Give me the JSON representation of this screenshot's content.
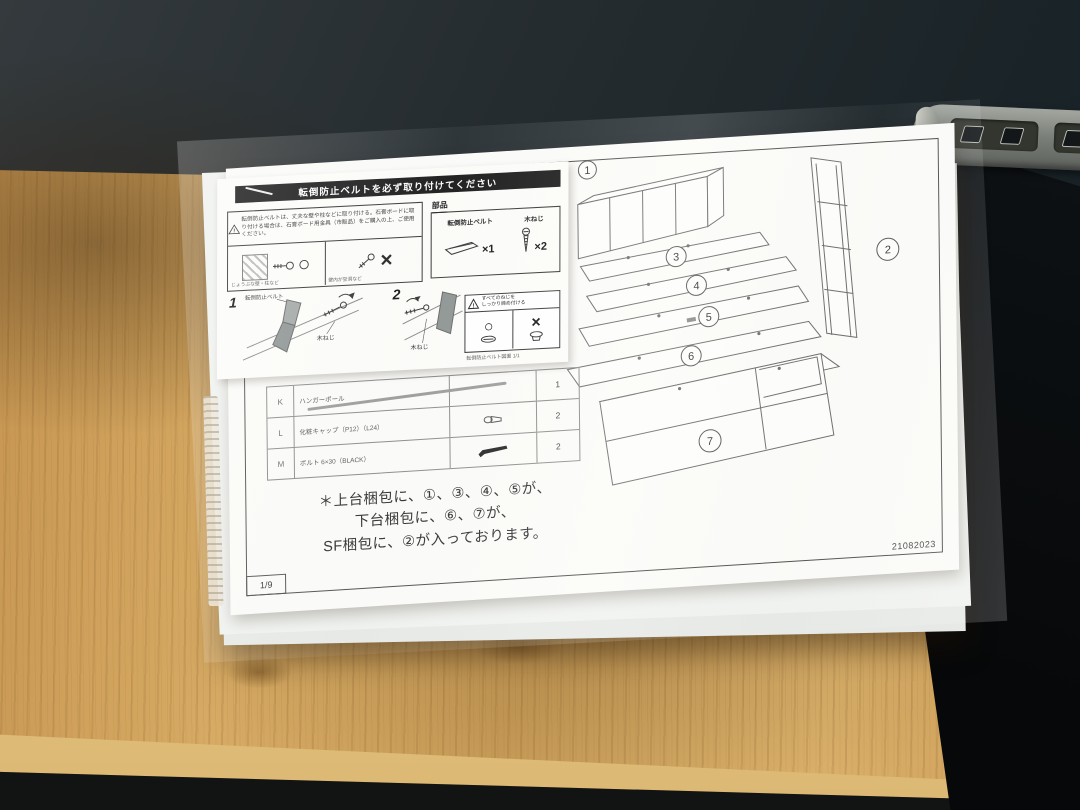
{
  "overlay_sheet": {
    "header": "転倒防止ベルトを必ず取り付けてください",
    "warning_text": "転倒防止ベルトは、丈夫な壁や柱などに取り付ける。石膏ボードに取り付ける場合は、石膏ボード用金具（市販品）をご購入の上、ご使用ください。",
    "ok_mark": "○",
    "ng_mark": "×",
    "ok_caption": "じょうぶな壁・柱など",
    "ng_caption": "壁内が空洞など",
    "parts_title": "部品",
    "belt_label": "転倒防止ベルト",
    "belt_qty": "×1",
    "screw_label": "木ねじ",
    "screw_qty": "×2",
    "step1_no": "1",
    "step1_belt_label": "転倒防止ベルト",
    "step1_screw_label": "木ねじ",
    "step2_no": "2",
    "step2_screw_label": "木ねじ",
    "tighten_line1": "すべてのねじを",
    "tighten_line2": "しっかり締め付ける",
    "tighten_ok": "○",
    "tighten_ng": "×",
    "footer_note": "転倒防止ベルト図面 1/1"
  },
  "main_sheet": {
    "parts_table": {
      "rows": [
        {
          "code": "K",
          "name": "ハンガーポール",
          "qty": "1"
        },
        {
          "code": "L",
          "name": "化粧キャップ（P12）（L24）",
          "qty": "2"
        },
        {
          "code": "M",
          "name": "ボルト 6×30（BLACK）",
          "qty": "2"
        }
      ]
    },
    "note_line1": "＊上台梱包に、①、③、④、⑤が、",
    "note_line2": "下台梱包に、⑥、⑦が、",
    "note_line3": "SF梱包に、②が入っております。",
    "page_number": "1/9",
    "doc_code": "21082023",
    "callouts": {
      "c1": "1",
      "c2": "2",
      "c3": "3",
      "c4": "4",
      "c5": "5",
      "c6": "6",
      "c7": "7"
    }
  },
  "colors": {
    "wall": "#232a2e",
    "wood": "#cfa25c",
    "paper": "#fbfbf8",
    "header_bar": "#181818",
    "line": "#4c4c4c"
  }
}
